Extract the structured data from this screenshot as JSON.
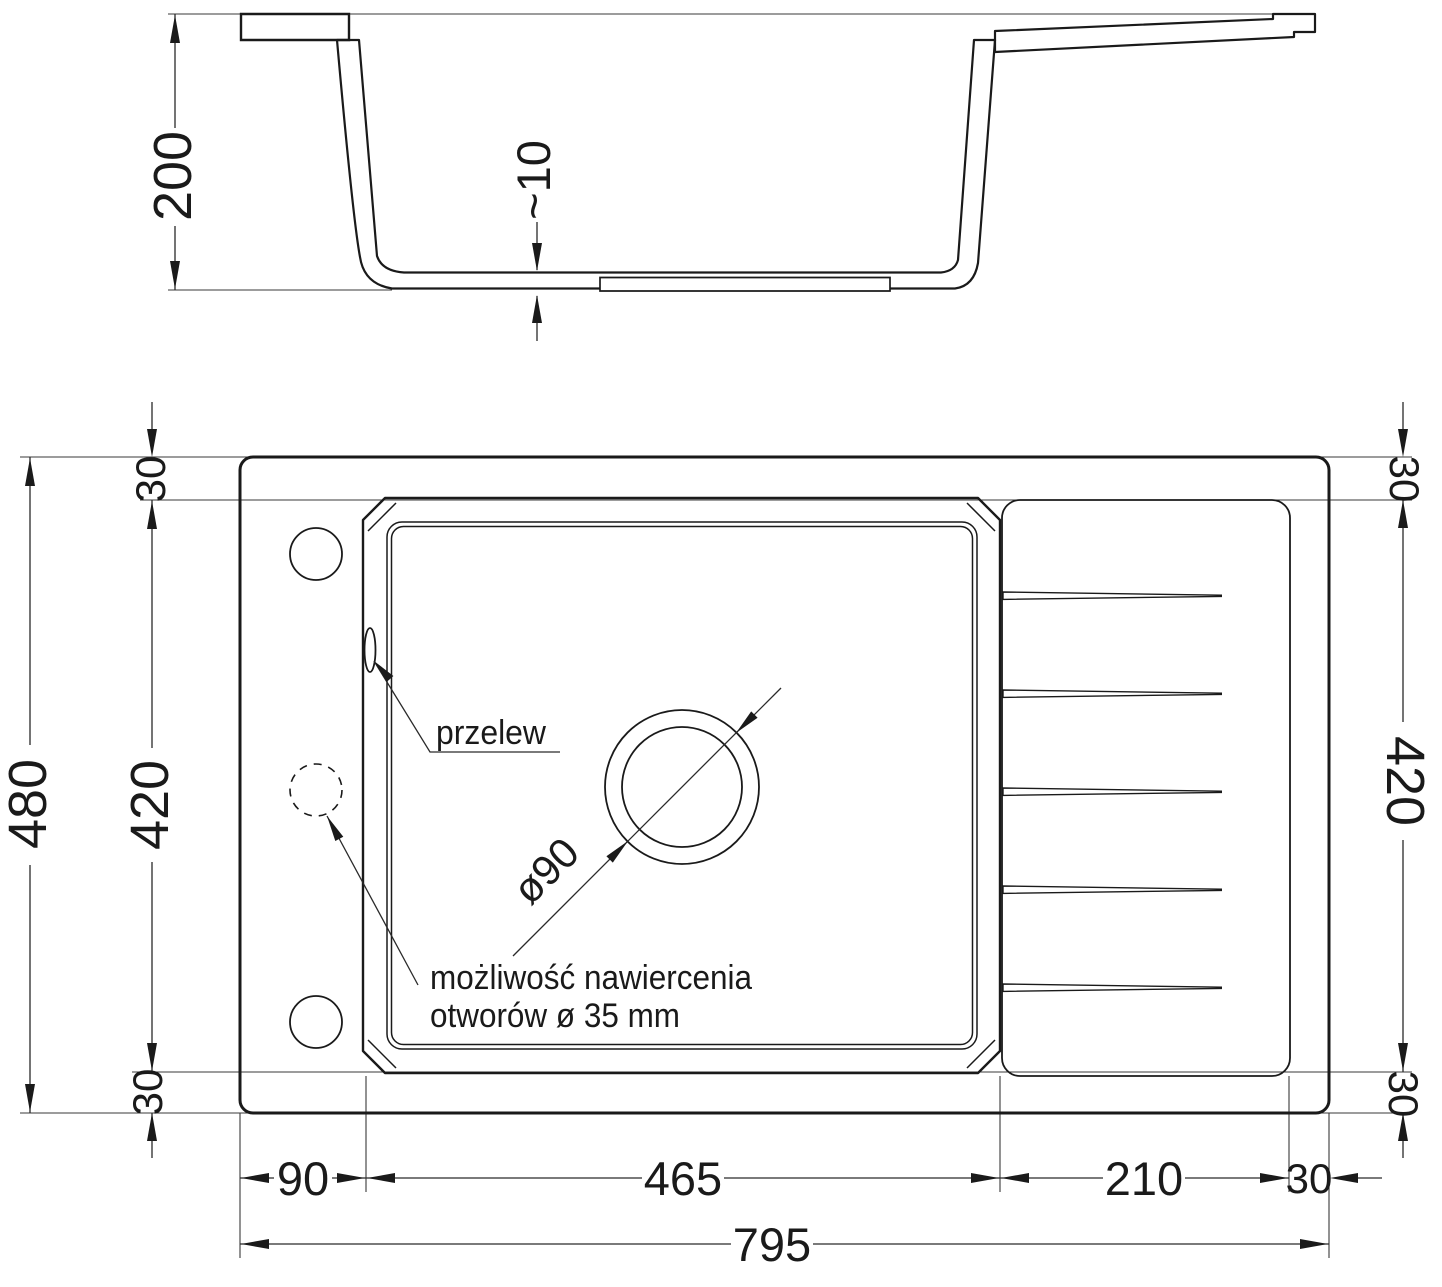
{
  "drawing": {
    "section": {
      "depth": "200",
      "bottom_thickness": "~10"
    },
    "plan": {
      "overflow_label": "przelew",
      "drill_note_line1": "możliwość nawiercenia",
      "drill_note_line2": "otworów ø 35 mm",
      "drain_diameter": "ø90",
      "height_total": "480",
      "height_bowl_left": "420",
      "margin_top_left": "30",
      "margin_bottom_left": "30",
      "margin_top_right": "30",
      "height_bowl_right": "420",
      "margin_bottom_right": "30",
      "offset_left": "90",
      "bowl_width": "465",
      "drainer_width": "210",
      "margin_right": "30",
      "width_total": "795"
    },
    "colors": {
      "line": "#1a1a1a",
      "thin_line": "#3a3a3a",
      "background": "#ffffff"
    }
  }
}
